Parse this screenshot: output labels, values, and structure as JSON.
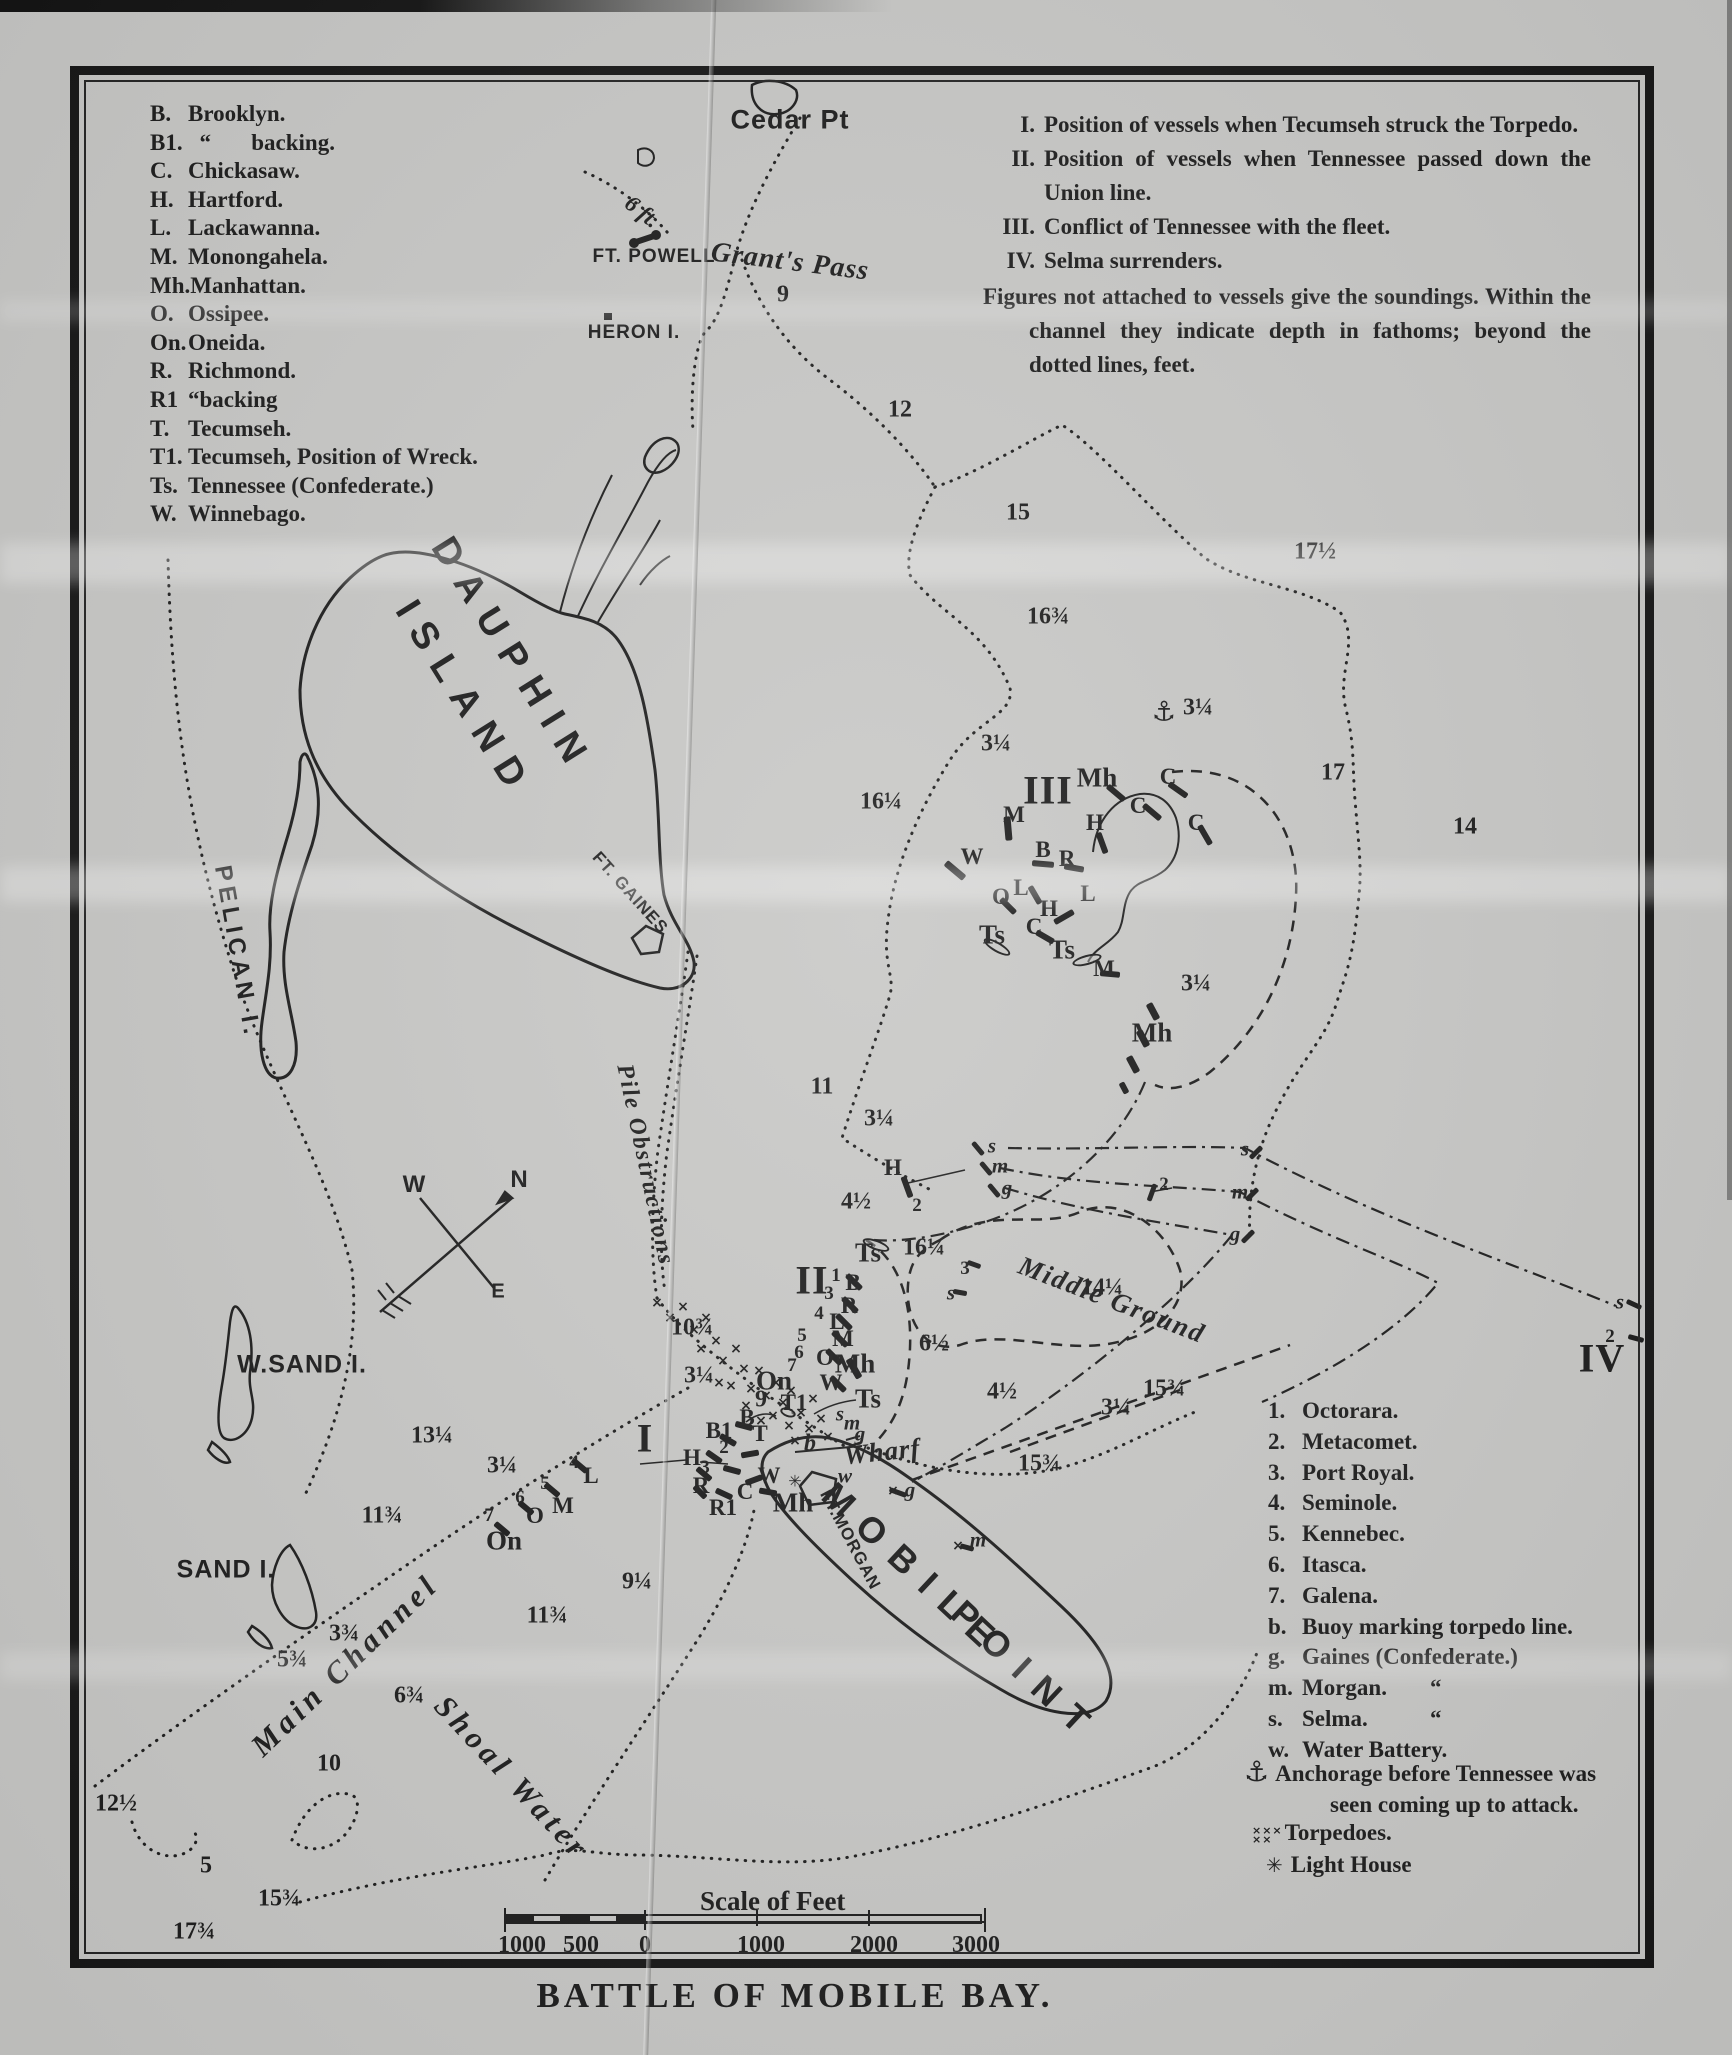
{
  "title": "BATTLE OF MOBILE BAY.",
  "scale_bar": {
    "caption": "Scale of Feet",
    "labels": [
      "1000",
      "500",
      "0",
      "1000",
      "2000",
      "3000"
    ]
  },
  "legend_vessels": {
    "items": [
      [
        "B.",
        "Brooklyn."
      ],
      [
        "B1.",
        "  “       backing."
      ],
      [
        "C.",
        "Chickasaw."
      ],
      [
        "H.",
        "Hartford."
      ],
      [
        "L.",
        "Lackawanna."
      ],
      [
        "M.",
        "Monongahela."
      ],
      [
        "Mh.",
        "Manhattan."
      ],
      [
        "O.",
        "Ossipee."
      ],
      [
        "On.",
        "Oneida."
      ],
      [
        "R.",
        "Richmond."
      ],
      [
        "R1",
        "“backing"
      ],
      [
        "T.",
        "Tecumseh."
      ],
      [
        "T1.",
        "Tecumseh, Position of Wreck."
      ],
      [
        "Ts.",
        "Tennessee (Confederate.)"
      ],
      [
        "W.",
        "Winnebago."
      ]
    ]
  },
  "legend_notes": {
    "items": [
      [
        "I.",
        "Position of vessels when Tecumseh struck the Torpedo."
      ],
      [
        "II.",
        "Position of vessels when Tennessee passed down the Union line."
      ],
      [
        "III.",
        "Conflict of Tennessee with the fleet."
      ],
      [
        "IV.",
        "Selma surrenders."
      ],
      [
        "",
        "Figures not attached to vessels give the soundings.   Within the channel they indicate depth in fathoms; beyond the dotted lines, feet."
      ]
    ]
  },
  "legend_fleet": {
    "items": [
      [
        "1.",
        "Octorara.",
        ""
      ],
      [
        "2.",
        "Metacomet.",
        ""
      ],
      [
        "3.",
        "Port Royal.",
        ""
      ],
      [
        "4.",
        "Seminole.",
        ""
      ],
      [
        "5.",
        "Kennebec.",
        ""
      ],
      [
        "6.",
        "Itasca.",
        ""
      ],
      [
        "7.",
        "Galena.",
        ""
      ],
      [
        "b.",
        "Buoy marking torpedo line.",
        ""
      ],
      [
        "g.",
        "Gaines (Confederate.)",
        ""
      ],
      [
        "m.",
        "Morgan.",
        "“"
      ],
      [
        "s.",
        "Selma.",
        "“"
      ],
      [
        "w.",
        "Water Battery.",
        ""
      ]
    ],
    "anchor_symbol": "⚓",
    "anchor_note_1": "Anchorage before Tennessee was",
    "anchor_note_2": "seen coming up to attack.",
    "torpedo_symbol": "×××\n××",
    "torpedoes_label": "Torpedoes.",
    "lighthouse_symbol": "✳",
    "lighthouse_label": "Light House"
  },
  "map": {
    "ink": "#1d1d1d",
    "paper": "#c8c8c6",
    "place_labels": [
      [
        "Cedar Pt",
        790,
        120,
        0,
        27,
        1,
        "s"
      ],
      [
        "6 ft.",
        642,
        212,
        38,
        23,
        0,
        "i"
      ],
      [
        "FT. POWELL",
        654,
        257,
        0,
        19,
        1,
        "ss"
      ],
      [
        "Grant's Pass",
        790,
        262,
        7,
        28,
        1,
        "i"
      ],
      [
        "HERON I.",
        634,
        333,
        0,
        19,
        1,
        "ss"
      ],
      [
        "DAUPHIN",
        512,
        656,
        58,
        38,
        14,
        "s"
      ],
      [
        "ISLAND",
        464,
        700,
        58,
        38,
        14,
        "s"
      ],
      [
        "PELICAN I.",
        237,
        952,
        80,
        24,
        5,
        "s"
      ],
      [
        "FT. GAINES",
        630,
        893,
        48,
        17,
        1,
        "ss"
      ],
      [
        "W.SAND I.",
        302,
        1365,
        0,
        25,
        1,
        "s"
      ],
      [
        "SAND I.",
        226,
        1570,
        0,
        25,
        1,
        "s"
      ],
      [
        "Wharf",
        882,
        1452,
        -6,
        27,
        1,
        "i"
      ],
      [
        "FT.MORGAN",
        850,
        1540,
        62,
        17,
        1,
        "ss"
      ],
      [
        "MOBILE",
        914,
        1570,
        43,
        36,
        16,
        "s"
      ],
      [
        "POINT",
        1026,
        1672,
        43,
        36,
        16,
        "s"
      ],
      [
        "Middle Ground",
        1112,
        1300,
        21,
        27,
        2,
        "ib"
      ],
      [
        "Main Channel",
        345,
        1665,
        -44,
        31,
        5,
        "ib"
      ],
      [
        "Shoal Water",
        512,
        1778,
        47,
        31,
        5,
        "ib"
      ],
      [
        "Pile Obstructions",
        645,
        1165,
        78,
        24,
        2,
        "i"
      ],
      [
        "N",
        519,
        1180,
        0,
        24,
        0,
        "s"
      ],
      [
        "W",
        414,
        1185,
        0,
        24,
        0,
        "s"
      ],
      [
        "E",
        498,
        1292,
        0,
        20,
        0,
        "s"
      ]
    ],
    "soundings": [
      [
        "9",
        783,
        295
      ],
      [
        "12",
        900,
        410
      ],
      [
        "15",
        1018,
        513
      ],
      [
        "17½",
        1315,
        552
      ],
      [
        "16¾",
        1048,
        617
      ],
      [
        "3¼",
        996,
        744
      ],
      [
        "3¼",
        1198,
        708
      ],
      [
        "17",
        1333,
        773
      ],
      [
        "14",
        1465,
        827
      ],
      [
        "16¼",
        881,
        802
      ],
      [
        "3¼",
        1196,
        984
      ],
      [
        "11",
        822,
        1087
      ],
      [
        "3¼",
        879,
        1119
      ],
      [
        "4½",
        856,
        1202
      ],
      [
        "16¼",
        924,
        1248
      ],
      [
        "14¼",
        1102,
        1288
      ],
      [
        "6½",
        934,
        1344
      ],
      [
        "4½",
        1002,
        1392
      ],
      [
        "3¼",
        1116,
        1408
      ],
      [
        "15¾",
        1164,
        1389
      ],
      [
        "15¾",
        1039,
        1464
      ],
      [
        "10¾",
        692,
        1328
      ],
      [
        "3¼",
        699,
        1376
      ],
      [
        "13¼",
        432,
        1436
      ],
      [
        "11¾",
        382,
        1516
      ],
      [
        "3¼",
        502,
        1466
      ],
      [
        "11¾",
        547,
        1616
      ],
      [
        "9¼",
        637,
        1582
      ],
      [
        "3¾",
        344,
        1634
      ],
      [
        "5¾",
        292,
        1660
      ],
      [
        "6¾",
        409,
        1696
      ],
      [
        "10",
        329,
        1764
      ],
      [
        "12½",
        116,
        1804
      ],
      [
        "5",
        206,
        1866
      ],
      [
        "15¾",
        279,
        1899
      ],
      [
        "17¾",
        194,
        1932
      ],
      [
        "9",
        761,
        1400
      ]
    ],
    "markers": [
      [
        "I",
        645,
        1438,
        "rom"
      ],
      [
        "II",
        812,
        1280,
        "rom"
      ],
      [
        "III",
        1048,
        790,
        "rom"
      ],
      [
        "IV",
        1602,
        1358,
        "rom"
      ],
      [
        "⚓",
        1164,
        712,
        "anch"
      ],
      [
        "Mh",
        1097,
        778,
        "big"
      ],
      [
        "M",
        1014,
        815,
        "med"
      ],
      [
        "H",
        1095,
        823,
        "med"
      ],
      [
        "C",
        1168,
        777,
        "med"
      ],
      [
        "C",
        1138,
        806,
        "med"
      ],
      [
        "C",
        1196,
        823,
        "med"
      ],
      [
        "W",
        972,
        857,
        "med"
      ],
      [
        "B",
        1043,
        850,
        "med"
      ],
      [
        "R",
        1067,
        859,
        "med"
      ],
      [
        "O",
        1001,
        897,
        "med"
      ],
      [
        "L",
        1021,
        888,
        "med"
      ],
      [
        "H",
        1049,
        909,
        "med"
      ],
      [
        "L",
        1088,
        894,
        "med"
      ],
      [
        "C",
        1034,
        927,
        "med"
      ],
      [
        "Ts",
        992,
        935,
        "big"
      ],
      [
        "Ts",
        1062,
        950,
        "big"
      ],
      [
        "M",
        1104,
        969,
        "med"
      ],
      [
        "Mh",
        1152,
        1033,
        "big"
      ],
      [
        "s",
        992,
        1146,
        "smi"
      ],
      [
        "m",
        1000,
        1166,
        "smi"
      ],
      [
        "g",
        1007,
        1188,
        "smi"
      ],
      [
        "2",
        1164,
        1185,
        "sm"
      ],
      [
        "s",
        1245,
        1149,
        "smi"
      ],
      [
        "m",
        1240,
        1192,
        "smi"
      ],
      [
        "g",
        1235,
        1234,
        "smi"
      ],
      [
        "H",
        893,
        1168,
        "med"
      ],
      [
        "2",
        917,
        1206,
        "sm"
      ],
      [
        "3",
        965,
        1269,
        "sm"
      ],
      [
        "s",
        951,
        1293,
        "smi"
      ],
      [
        "s",
        1620,
        1302,
        "smi"
      ],
      [
        "2",
        1610,
        1337,
        "sm"
      ],
      [
        "Ts",
        868,
        1253,
        "big"
      ],
      [
        "1",
        836,
        1276,
        "sm"
      ],
      [
        "B",
        853,
        1283,
        "med"
      ],
      [
        "3",
        829,
        1294,
        "sm"
      ],
      [
        "R",
        849,
        1306,
        "med"
      ],
      [
        "4",
        819,
        1314,
        "sm"
      ],
      [
        "L",
        837,
        1322,
        "med"
      ],
      [
        "5",
        802,
        1336,
        "sm"
      ],
      [
        "M",
        843,
        1339,
        "med"
      ],
      [
        "6",
        799,
        1353,
        "sm"
      ],
      [
        "O",
        825,
        1358,
        "med"
      ],
      [
        "7",
        792,
        1366,
        "sm"
      ],
      [
        "Mh",
        855,
        1364,
        "big"
      ],
      [
        "On",
        774,
        1381,
        "big"
      ],
      [
        "W",
        831,
        1383,
        "med"
      ],
      [
        "T1",
        794,
        1403,
        "med"
      ],
      [
        "Ts",
        868,
        1399,
        "big"
      ],
      [
        "s",
        840,
        1414,
        "smi"
      ],
      [
        "m",
        852,
        1423,
        "smi"
      ],
      [
        "g",
        860,
        1434,
        "smi"
      ],
      [
        "b",
        810,
        1444,
        "medi"
      ],
      [
        "B",
        747,
        1418,
        "med"
      ],
      [
        "B1",
        719,
        1431,
        "med"
      ],
      [
        "2",
        724,
        1448,
        "sm"
      ],
      [
        "H",
        692,
        1458,
        "med"
      ],
      [
        "3",
        705,
        1468,
        "sm"
      ],
      [
        "R",
        701,
        1486,
        "med"
      ],
      [
        "C",
        745,
        1492,
        "med"
      ],
      [
        "W",
        769,
        1476,
        "med"
      ],
      [
        "T",
        760,
        1434,
        "med"
      ],
      [
        "R1",
        723,
        1508,
        "med"
      ],
      [
        "Mh",
        793,
        1503,
        "big"
      ],
      [
        "w",
        845,
        1476,
        "smi"
      ],
      [
        "✳",
        795,
        1481,
        "star"
      ],
      [
        "4",
        574,
        1463,
        "sm"
      ],
      [
        "L",
        591,
        1476,
        "med"
      ],
      [
        "5",
        545,
        1484,
        "sm"
      ],
      [
        "M",
        563,
        1506,
        "med"
      ],
      [
        "6",
        520,
        1498,
        "sm"
      ],
      [
        "O",
        535,
        1516,
        "med"
      ],
      [
        "7",
        489,
        1516,
        "sm"
      ],
      [
        "On",
        504,
        1541,
        "big"
      ],
      [
        "m",
        978,
        1540,
        "smi"
      ],
      [
        "g",
        910,
        1490,
        "smi"
      ]
    ],
    "ships": [
      [
        1008,
        828,
        85,
        24,
        7,
        0
      ],
      [
        1116,
        793,
        40,
        22,
        6,
        0
      ],
      [
        1102,
        843,
        70,
        22,
        6,
        0
      ],
      [
        1178,
        790,
        35,
        22,
        6,
        0
      ],
      [
        1152,
        812,
        40,
        22,
        6,
        0
      ],
      [
        1205,
        835,
        60,
        22,
        6,
        0
      ],
      [
        955,
        870,
        40,
        24,
        7,
        0
      ],
      [
        1043,
        864,
        5,
        22,
        6,
        0
      ],
      [
        1074,
        868,
        10,
        20,
        6,
        0
      ],
      [
        1008,
        906,
        45,
        20,
        6,
        0
      ],
      [
        1035,
        895,
        60,
        20,
        6,
        0
      ],
      [
        1064,
        917,
        -30,
        22,
        6,
        0
      ],
      [
        1045,
        937,
        30,
        20,
        6,
        0
      ],
      [
        1110,
        974,
        5,
        20,
        6,
        0
      ],
      [
        997,
        947,
        30,
        30,
        10,
        1
      ],
      [
        1087,
        960,
        -15,
        30,
        10,
        1
      ],
      [
        1133,
        1064,
        62,
        18,
        7,
        0
      ],
      [
        1143,
        1038,
        62,
        18,
        7,
        0
      ],
      [
        1153,
        1011,
        62,
        18,
        7,
        0
      ],
      [
        1124,
        1088,
        62,
        12,
        6,
        0
      ],
      [
        854,
        1282,
        45,
        20,
        6,
        0
      ],
      [
        850,
        1305,
        45,
        20,
        6,
        0
      ],
      [
        844,
        1322,
        45,
        20,
        6,
        0
      ],
      [
        840,
        1339,
        45,
        20,
        6,
        0
      ],
      [
        834,
        1357,
        45,
        20,
        6,
        0
      ],
      [
        854,
        1368,
        60,
        22,
        7,
        0
      ],
      [
        838,
        1384,
        45,
        20,
        6,
        0
      ],
      [
        876,
        1245,
        20,
        28,
        10,
        1
      ],
      [
        978,
        1148,
        50,
        16,
        5,
        0
      ],
      [
        986,
        1168,
        50,
        16,
        5,
        0
      ],
      [
        994,
        1190,
        50,
        16,
        5,
        0
      ],
      [
        1152,
        1192,
        -70,
        18,
        5,
        0
      ],
      [
        1256,
        1152,
        -45,
        16,
        5,
        0
      ],
      [
        1252,
        1194,
        -45,
        16,
        5,
        0
      ],
      [
        1248,
        1236,
        -45,
        16,
        5,
        0
      ],
      [
        1634,
        1304,
        25,
        16,
        5,
        0
      ],
      [
        1636,
        1338,
        15,
        16,
        5,
        0
      ],
      [
        974,
        1264,
        20,
        14,
        5,
        0
      ],
      [
        960,
        1292,
        10,
        14,
        5,
        0
      ],
      [
        907,
        1187,
        70,
        22,
        6,
        0
      ],
      [
        744,
        1426,
        15,
        18,
        6,
        0
      ],
      [
        728,
        1440,
        30,
        18,
        6,
        0
      ],
      [
        750,
        1454,
        -10,
        18,
        6,
        0
      ],
      [
        714,
        1457,
        35,
        18,
        6,
        0
      ],
      [
        732,
        1470,
        15,
        18,
        6,
        0
      ],
      [
        704,
        1474,
        40,
        18,
        6,
        0
      ],
      [
        754,
        1480,
        -20,
        18,
        6,
        0
      ],
      [
        724,
        1494,
        25,
        18,
        6,
        0
      ],
      [
        768,
        1492,
        10,
        18,
        6,
        0
      ],
      [
        700,
        1492,
        45,
        16,
        6,
        0
      ],
      [
        788,
        1412,
        20,
        16,
        9,
        1
      ],
      [
        580,
        1466,
        40,
        18,
        6,
        0
      ],
      [
        552,
        1490,
        40,
        18,
        6,
        0
      ],
      [
        526,
        1508,
        40,
        18,
        6,
        0
      ],
      [
        502,
        1529,
        40,
        18,
        6,
        0
      ],
      [
        898,
        1492,
        20,
        18,
        5,
        0
      ],
      [
        967,
        1547,
        15,
        14,
        5,
        0
      ]
    ],
    "torpedoes": [
      [
        657,
        1303
      ],
      [
        670,
        1318
      ],
      [
        683,
        1307
      ],
      [
        694,
        1330
      ],
      [
        706,
        1318
      ],
      [
        701,
        1349
      ],
      [
        716,
        1341
      ],
      [
        723,
        1361
      ],
      [
        736,
        1349
      ],
      [
        744,
        1369
      ],
      [
        731,
        1386
      ],
      [
        751,
        1389
      ],
      [
        759,
        1371
      ],
      [
        766,
        1396
      ],
      [
        776,
        1383
      ],
      [
        783,
        1403
      ],
      [
        791,
        1391
      ],
      [
        773,
        1416
      ],
      [
        789,
        1426
      ],
      [
        801,
        1413
      ],
      [
        809,
        1429
      ],
      [
        761,
        1421
      ],
      [
        746,
        1406
      ],
      [
        719,
        1383
      ],
      [
        813,
        1399
      ],
      [
        821,
        1419
      ],
      [
        795,
        1441
      ],
      [
        828,
        1437
      ],
      [
        958,
        1546
      ],
      [
        893,
        1491
      ]
    ]
  }
}
